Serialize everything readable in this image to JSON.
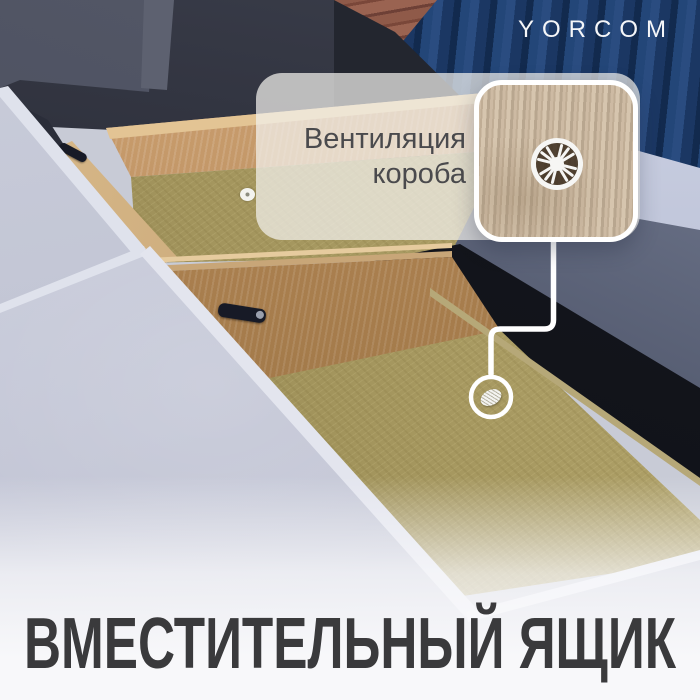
{
  "brand": {
    "logo": "YORCOM"
  },
  "callout": {
    "label_line1": "Вентиляция",
    "label_line2": "короба"
  },
  "headline": {
    "text": "ВМЕСТИТЕЛЬНЫЙ ЯЩИК"
  },
  "colors": {
    "container_blue": "#1b3763",
    "brick": "#8f5a49",
    "velvet_light": "#c6c9d7",
    "velvet_shadow": "#4e556a",
    "wood": "#b98b58",
    "chipboard": "#a89a62",
    "callout_wood": "#c4b29c",
    "line_white": "#ffffff",
    "headline_text": "#3a3a3c",
    "label_text": "#4a4a4d"
  }
}
